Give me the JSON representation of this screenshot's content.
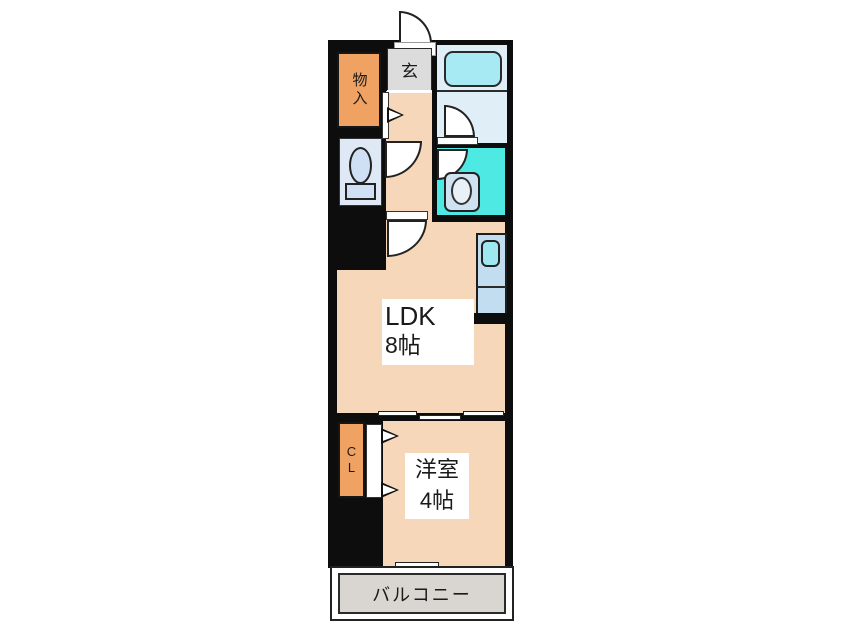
{
  "plan": {
    "storage_label": "物入",
    "entrance_label": "玄",
    "ldk_label": "LDK",
    "ldk_size": "8帖",
    "closet_label": "CL",
    "bedroom_label": "洋室",
    "bedroom_size": "4帖",
    "balcony_label": "バルコニー"
  },
  "colors": {
    "wall": "#0d0d0d",
    "floor": "#f6d7b9",
    "closet_orange": "#f0a263",
    "entry_gray": "#dcdcdc",
    "bathroom_blue": "#e0eef8",
    "bathtub_cyan": "#a8eaf3",
    "washroom_cyan": "#4de9e2",
    "toilet_blue": "#dfe9f6",
    "kitchen_blue": "#c2ddf0",
    "balcony_gray": "#d9d6d1"
  }
}
